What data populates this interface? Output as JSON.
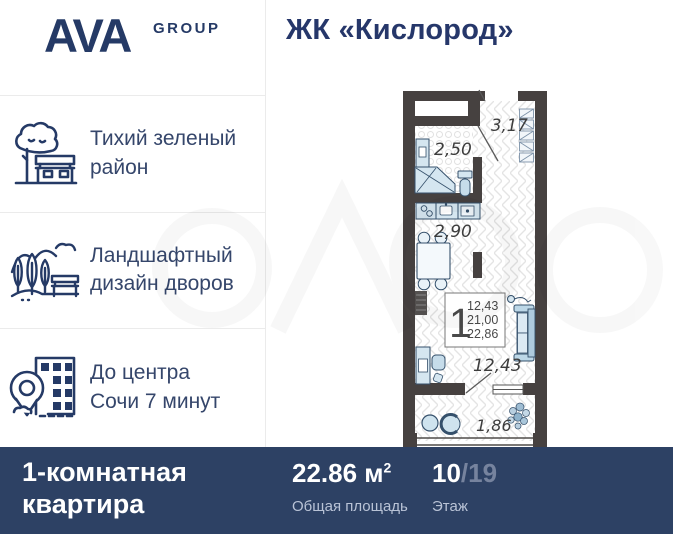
{
  "header": {
    "logo_main": "AVA",
    "logo_sub": "GROUP",
    "title": "ЖК «Кислород»"
  },
  "features": [
    {
      "icon": "tree-bench-icon",
      "lines": [
        "Тихий зеленый",
        "район"
      ]
    },
    {
      "icon": "landscape-icon",
      "lines": [
        "Ландшафтный",
        "дизайн дворов"
      ]
    },
    {
      "icon": "city-location-icon",
      "lines": [
        "До центра",
        "Сочи 7 минут"
      ]
    }
  ],
  "plan": {
    "labels": {
      "hallway": "3,17",
      "bathroom": "2,50",
      "kitchen": "2,90",
      "room": "12,43",
      "balcony": "1,86"
    },
    "info": {
      "rooms": "1",
      "areas": [
        "12,43",
        "21,00",
        "22,86"
      ]
    }
  },
  "footer": {
    "type_lines": [
      "1-комнатная",
      "квартира"
    ],
    "area_value": "22.86 м",
    "area_sup": "2",
    "area_label": "Общая площадь",
    "floor_value": "10",
    "floor_total": "/19",
    "floor_label": "Этаж"
  },
  "colors": {
    "navy": "#253a66",
    "bar_bg": "#2d4164",
    "wall": "#464140",
    "furniture_fill": "#cfe3ee",
    "furniture_stroke": "#35506b"
  }
}
